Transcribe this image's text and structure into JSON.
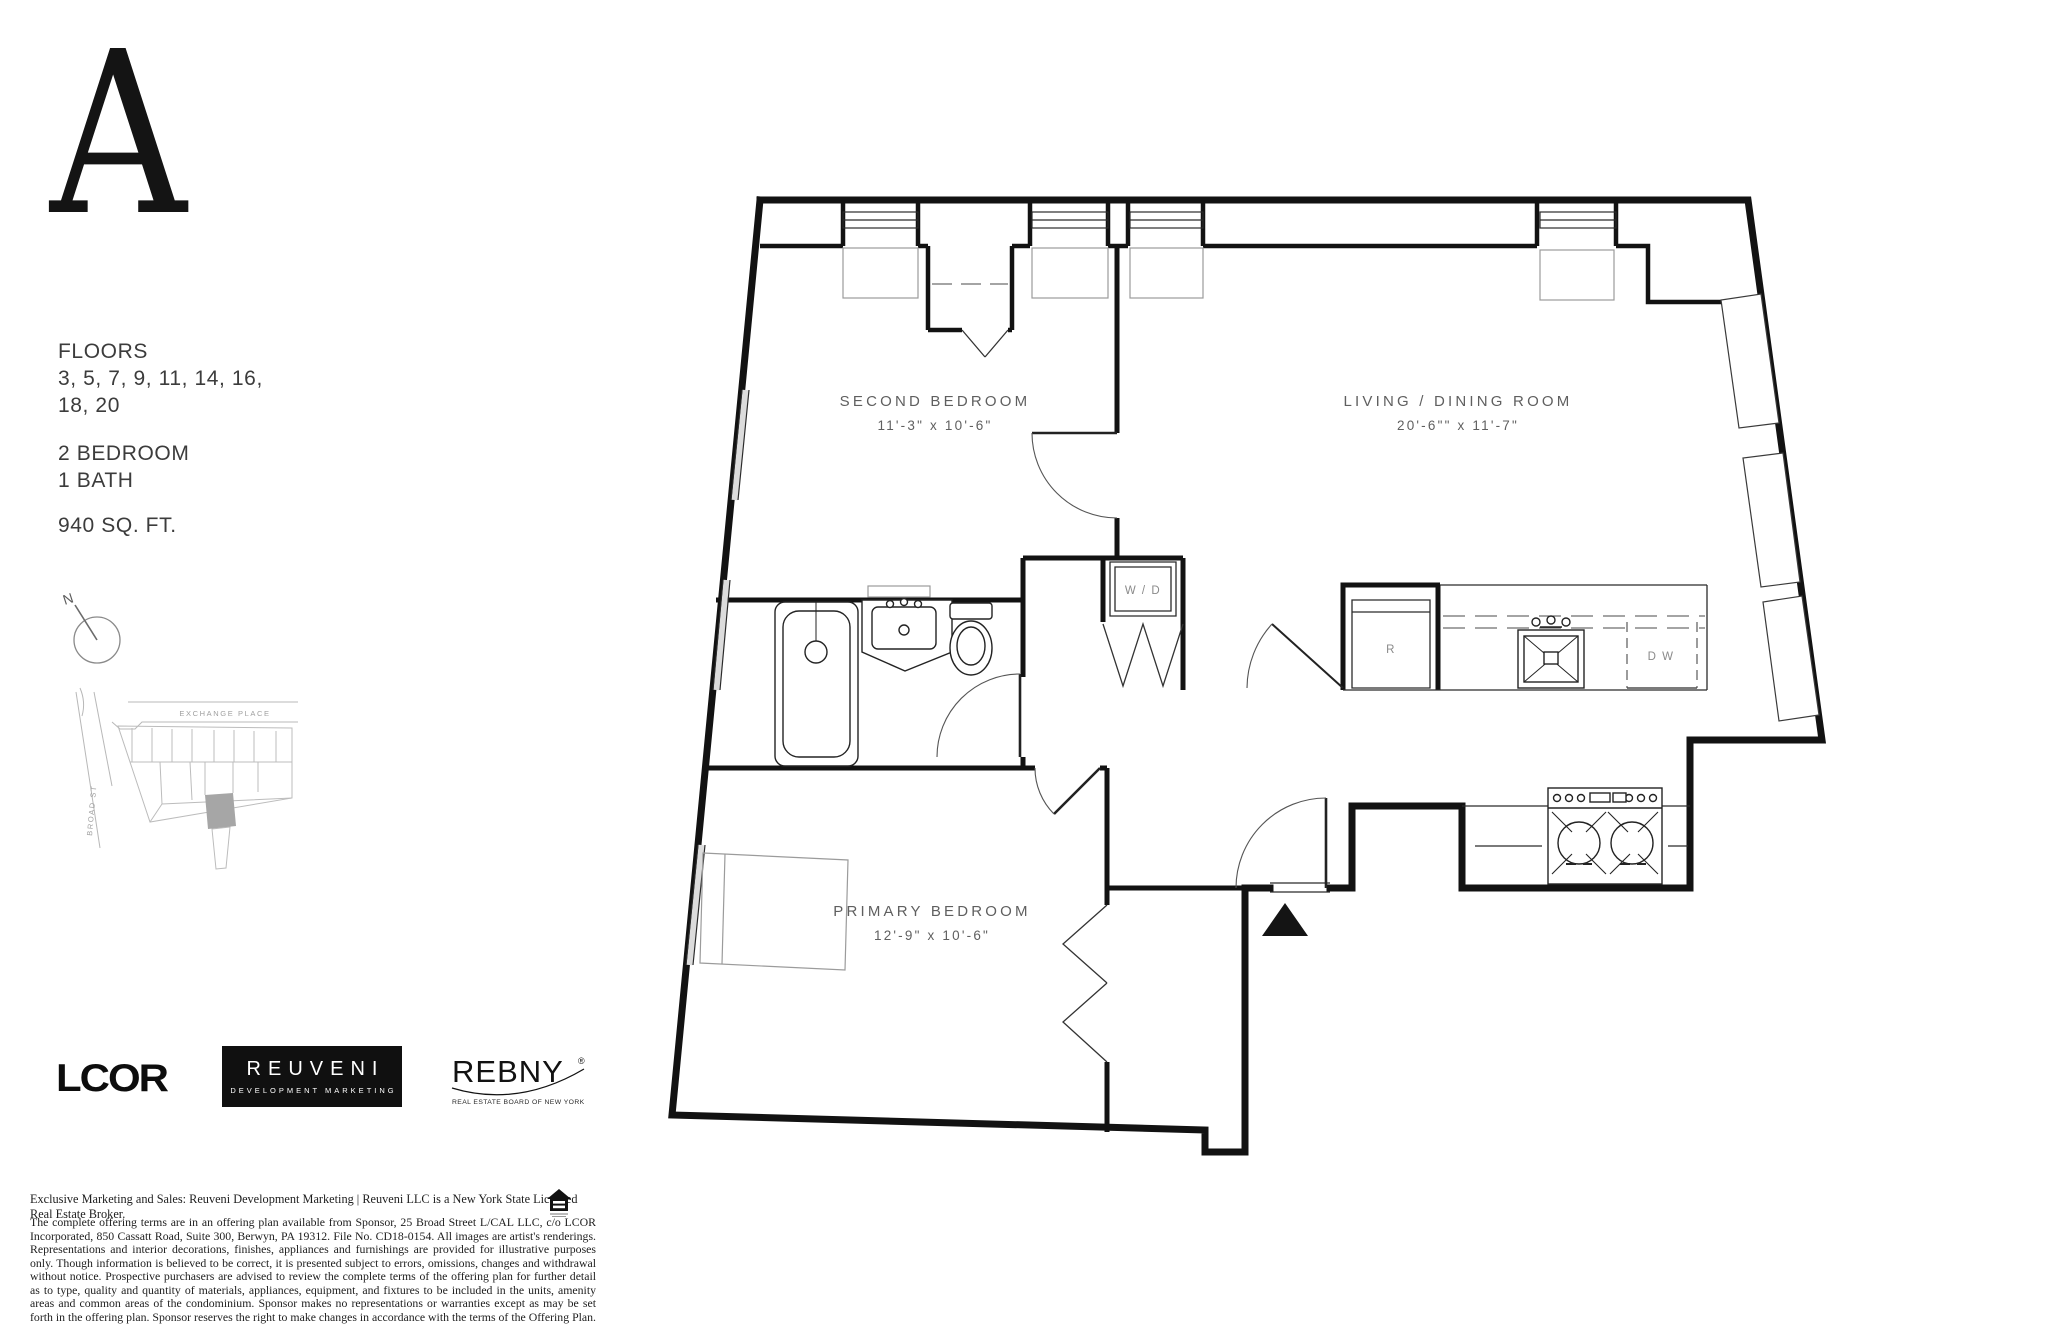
{
  "unit": {
    "letter": "A"
  },
  "info": {
    "floors_label": "FLOORS",
    "floors_line1": "3, 5, 7, 9, 11, 14, 16,",
    "floors_line2": "18, 20",
    "bedrooms": "2 BEDROOM",
    "bath": "1 BATH",
    "area": "940 SQ. FT."
  },
  "compass": {
    "north_label": "N"
  },
  "map": {
    "street_horizontal": "EXCHANGE PLACE",
    "street_vertical": "BROAD ST"
  },
  "floorplan": {
    "rooms": [
      {
        "name": "SECOND BEDROOM",
        "dims": "11'-3\" x 10'-6\""
      },
      {
        "name": "LIVING / DINING ROOM",
        "dims": "20'-6\"\" x 11'-7\""
      },
      {
        "name": "PRIMARY BEDROOM",
        "dims": "12'-9\" x 10'-6\""
      }
    ],
    "labels": {
      "washer_dryer": "W / D",
      "refrigerator": "R",
      "dishwasher": "D W"
    }
  },
  "logos": {
    "lcor": "LCOR",
    "reuveni_line1": "REUVENI",
    "reuveni_line2": "DEVELOPMENT MARKETING",
    "rebny": "REBNY",
    "rebny_reg": "®",
    "rebny_sub": "REAL ESTATE BOARD OF NEW YORK"
  },
  "legal": {
    "line1": "Exclusive Marketing and Sales: Reuveni Development Marketing | Reuveni LLC is a New York State Licensed Real Estate Broker.",
    "paragraph": "The complete offering terms are in an offering plan available from Sponsor, 25 Broad Street L/CAL LLC, c/o LCOR Incorporated, 850 Cassatt Road, Suite 300, Berwyn, PA 19312. File No. CD18-0154. All images are artist's renderings. Representations and interior decorations, finishes, appliances and furnishings are provided for illustrative purposes only. Though information is believed to be correct, it is presented subject to errors, omissions, changes and withdrawal without notice. Prospective purchasers are advised to review the complete terms of the offering plan for further detail as to type, quality and quantity of materials, appliances, equipment, and fixtures to be included in the units, amenity areas and common areas of the condominium. Sponsor makes no representations or warranties except as may be set forth in the offering plan. Sponsor reserves the right to make changes in accordance with the terms of the Offering Plan. Equal Housing Opportunity."
  },
  "colors": {
    "wall": "#121212",
    "thin_line": "#2b2b2b",
    "light_gray": "#9b9b9b",
    "label_gray": "#5f5f5f",
    "map_gray": "#b8b8b8",
    "highlight_building": "#a6a6a6"
  }
}
